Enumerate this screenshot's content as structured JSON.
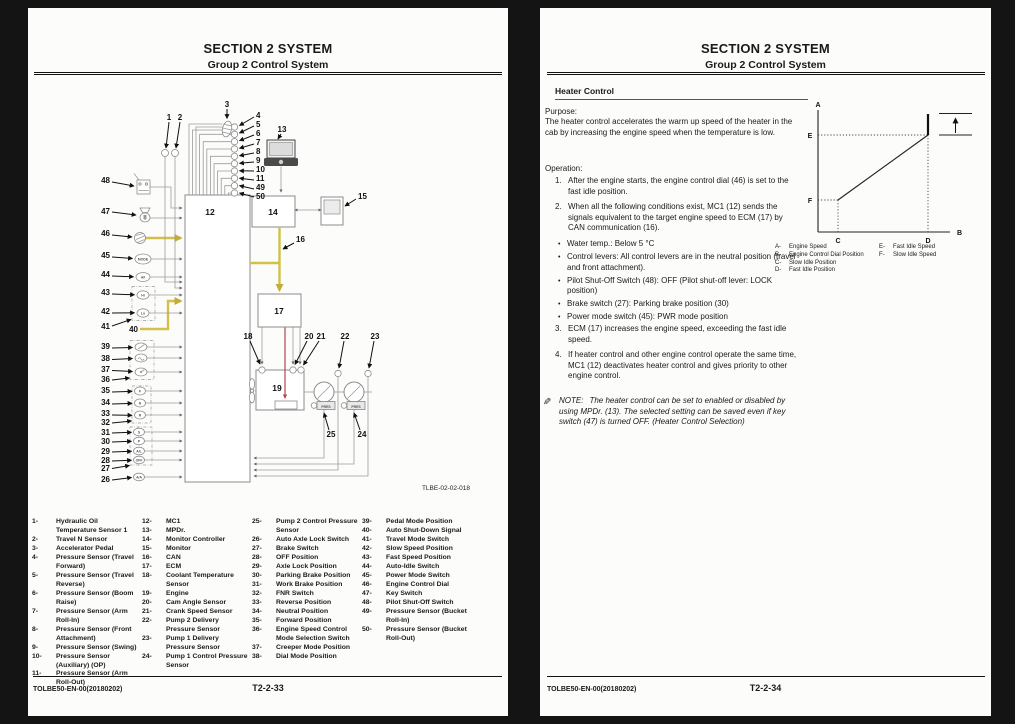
{
  "left_page": {
    "header": {
      "title": "SECTION 2 SYSTEM",
      "subtitle": "Group 2 Control System"
    },
    "figure_code": "TLBE-02-02-018",
    "footer": {
      "doc": "TOLBE50-EN-00(20180202)",
      "page": "T2-2-33"
    },
    "legend_columns": [
      [
        {
          "n": "1-",
          "t": "Hydraulic Oil Temperature Sensor 1"
        },
        {
          "n": "2-",
          "t": "Travel N Sensor"
        },
        {
          "n": "3-",
          "t": "Accelerator Pedal"
        },
        {
          "n": "4-",
          "t": "Pressure Sensor (Travel Forward)"
        },
        {
          "n": "5-",
          "t": "Pressure Sensor (Travel Reverse)"
        },
        {
          "n": "6-",
          "t": "Pressure Sensor (Boom Raise)"
        },
        {
          "n": "7-",
          "t": "Pressure Sensor (Arm Roll-In)"
        },
        {
          "n": "8-",
          "t": "Pressure Sensor (Front Attachment)"
        },
        {
          "n": "9-",
          "t": "Pressure Sensor (Swing)"
        },
        {
          "n": "10-",
          "t": "Pressure Sensor (Auxiliary) (OP)"
        },
        {
          "n": "11-",
          "t": "Pressure Sensor (Arm Roll-Out)"
        }
      ],
      [
        {
          "n": "12-",
          "t": "MC1"
        },
        {
          "n": "13-",
          "t": "MPDr."
        },
        {
          "n": "14-",
          "t": "Monitor Controller"
        },
        {
          "n": "15-",
          "t": "Monitor"
        },
        {
          "n": "16-",
          "t": "CAN"
        },
        {
          "n": "17-",
          "t": "ECM"
        },
        {
          "n": "18-",
          "t": "Coolant Temperature Sensor"
        },
        {
          "n": "19-",
          "t": "Engine"
        },
        {
          "n": "20-",
          "t": "Cam Angle Sensor"
        },
        {
          "n": "21-",
          "t": "Crank Speed Sensor"
        },
        {
          "n": "22-",
          "t": "Pump 2 Delivery Pressure Sensor"
        },
        {
          "n": "23-",
          "t": "Pump 1 Delivery Pressure Sensor"
        },
        {
          "n": "24-",
          "t": "Pump 1 Control Pressure Sensor"
        }
      ],
      [
        {
          "n": "25-",
          "t": "Pump 2 Control Pressure Sensor"
        },
        {
          "n": "26-",
          "t": "Auto Axle Lock Switch"
        },
        {
          "n": "27-",
          "t": "Brake Switch"
        },
        {
          "n": "28-",
          "t": "OFF Position"
        },
        {
          "n": "29-",
          "t": "Axle Lock Position"
        },
        {
          "n": "30-",
          "t": "Parking Brake Position"
        },
        {
          "n": "31-",
          "t": "Work Brake Position"
        },
        {
          "n": "32-",
          "t": "FNR Switch"
        },
        {
          "n": "33-",
          "t": "Reverse Position"
        },
        {
          "n": "34-",
          "t": "Neutral Position"
        },
        {
          "n": "35-",
          "t": "Forward Position"
        },
        {
          "n": "36-",
          "t": "Engine Speed Control Mode Selection Switch"
        },
        {
          "n": "37-",
          "t": "Creeper Mode Position"
        },
        {
          "n": "38-",
          "t": "Dial Mode Position"
        }
      ],
      [
        {
          "n": "39-",
          "t": "Pedal Mode Position"
        },
        {
          "n": "40-",
          "t": "Auto Shut-Down Signal"
        },
        {
          "n": "41-",
          "t": "Travel Mode Switch"
        },
        {
          "n": "42-",
          "t": "Slow Speed Position"
        },
        {
          "n": "43-",
          "t": "Fast Speed Position"
        },
        {
          "n": "44-",
          "t": "Auto-Idle Switch"
        },
        {
          "n": "45-",
          "t": "Power Mode Switch"
        },
        {
          "n": "46-",
          "t": "Engine Control Dial"
        },
        {
          "n": "47-",
          "t": "Key Switch"
        },
        {
          "n": "48-",
          "t": "Pilot Shut-Off Switch"
        },
        {
          "n": "49-",
          "t": "Pressure Sensor (Bucket Roll-In)"
        },
        {
          "n": "50-",
          "t": "Pressure Sensor (Bucket Roll-Out)"
        }
      ]
    ]
  },
  "right_page": {
    "header": {
      "title": "SECTION 2 SYSTEM",
      "subtitle": "Group 2 Control System"
    },
    "section_title": "Heater Control",
    "purpose": {
      "label": "Purpose:",
      "text": "The heater control accelerates the warm up speed of the heater in the cab by increasing the engine speed when the temperature is low."
    },
    "operation": {
      "label": "Operation:",
      "bullet_char": "•",
      "steps_before": [
        {
          "n": "1.",
          "t": "After the engine starts, the engine control dial (46) is set to the fast idle position."
        },
        {
          "n": "2.",
          "t": "When all the following conditions exist, MC1 (12) sends the signals equivalent to the target engine speed to ECM (17) by CAN communication (16)."
        }
      ],
      "conditions": [
        {
          "t": "Water temp.:  Below 5 °C"
        },
        {
          "t": "Control levers:  All control levers are in the neutral position (travel and front attachment)."
        },
        {
          "t": "Pilot Shut-Off Switch (48): OFF (Pilot shut-off lever:  LOCK position)"
        },
        {
          "t": "Brake switch (27): Parking brake position (30)"
        },
        {
          "t": "Power mode switch (45): PWR mode position"
        }
      ],
      "steps_after": [
        {
          "n": "3.",
          "t": "ECM (17) increases the engine speed, exceeding the fast idle speed."
        },
        {
          "n": "4.",
          "t": "If heater control and other engine control operate the same time, MC1 (12) deactivates heater control and gives priority to other engine control."
        }
      ]
    },
    "note": {
      "icon": "✎",
      "label": "NOTE:",
      "text": "The heater control can be set to enabled or disabled by using MPDr. (13). The selected setting can be saved even if key switch (47) is turned OFF. (Heater Control Selection)"
    },
    "footer": {
      "doc": "TOLBE50-EN-00(20180202)",
      "page": "T2-2-34"
    }
  },
  "chart_data": {
    "type": "line",
    "title": "Heater control: engine speed vs engine control dial position",
    "xlabel": "B (Engine Control Dial Position)",
    "ylabel": "A (Engine Speed)",
    "labels": {
      "a": "A",
      "b": "B",
      "c": "C",
      "d": "D",
      "e": "E",
      "f": "F"
    },
    "series": [
      {
        "name": "Engine speed vs dial position",
        "points": [
          {
            "x": "C (Slow Idle Position)",
            "y": "F (Slow Idle Speed)"
          },
          {
            "x": "D (Fast Idle Position)",
            "y": "E (Fast Idle Speed)"
          }
        ]
      },
      {
        "name": "Heater control increase",
        "points": [
          {
            "x": "D (Fast Idle Position)",
            "y": "E (Fast Idle Speed)"
          },
          {
            "x": "D (Fast Idle Position)",
            "y": "above E — heater control raises speed beyond fast idle"
          }
        ]
      }
    ],
    "annotations": [
      "Up arrow at right of plot indicates the speed increase above fast idle speed caused by heater control"
    ],
    "grid": false,
    "legend_position": "below",
    "legend_left": [
      {
        "k": "A-",
        "v": "Engine Speed"
      },
      {
        "k": "B-",
        "v": "Engine Control Dial Position"
      },
      {
        "k": "C-",
        "v": "Slow Idle Position"
      },
      {
        "k": "D-",
        "v": "Fast Idle Position"
      }
    ],
    "legend_right": [
      {
        "k": "E-",
        "v": "Fast Idle Speed"
      },
      {
        "k": "F-",
        "v": "Slow Idle Speed"
      }
    ]
  },
  "diagram": {
    "accent_colors": {
      "can_yellow": "#d2c04a",
      "signal_red": "#b0484a"
    },
    "callouts": {
      "n1": "1",
      "n2": "2",
      "n3": "3",
      "n4": "4",
      "n5": "5",
      "n6": "6",
      "n7": "7",
      "n8": "8",
      "n9": "9",
      "n10": "10",
      "n11": "11",
      "n12": "12",
      "n13": "13",
      "n14": "14",
      "n15": "15",
      "n16": "16",
      "n17": "17",
      "n18": "18",
      "n19": "19",
      "n20": "20",
      "n21": "21",
      "n22": "22",
      "n23": "23",
      "n24": "24",
      "n25": "25",
      "n26": "26",
      "n27": "27",
      "n28": "28",
      "n29": "29",
      "n30": "30",
      "n31": "31",
      "n32": "32",
      "n33": "33",
      "n34": "34",
      "n35": "35",
      "n36": "36",
      "n37": "37",
      "n38": "38",
      "n39": "39",
      "n40": "40",
      "n41": "41",
      "n42": "42",
      "n43": "43",
      "n44": "44",
      "n45": "45",
      "n46": "46",
      "n47": "47",
      "n48": "48",
      "n49": "49",
      "n50": "50"
    },
    "icon_texts": {
      "mode": "MODE",
      "ai": "A/I",
      "hi": "Hi",
      "lo": "Lo",
      "f": "F",
      "n": "N",
      "r": "R",
      "s": "S",
      "p": "P",
      "al": "A/L",
      "off": "OFF",
      "aa": "A/A",
      "pres": "PRES"
    }
  }
}
